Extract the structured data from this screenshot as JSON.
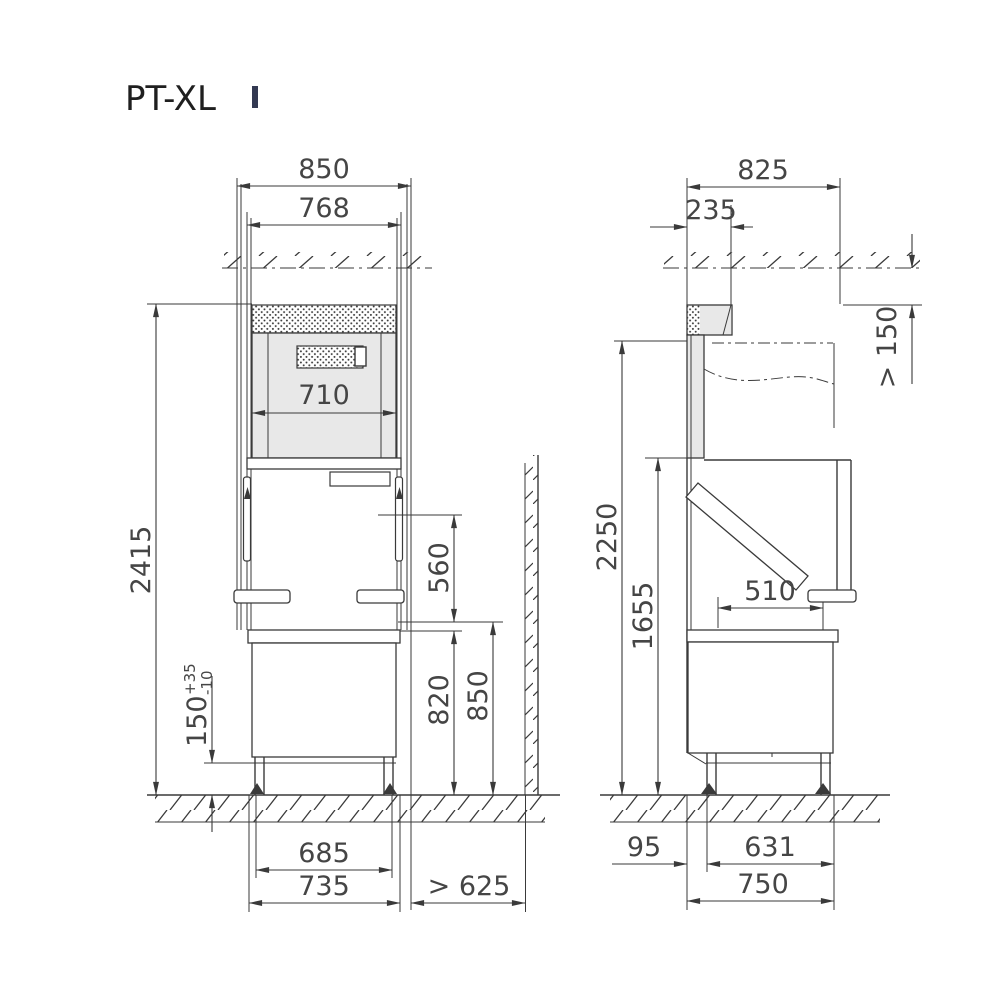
{
  "title": "PT-XL",
  "colors": {
    "line": "#3a3a3a",
    "panel_gray": "#e8e8e8"
  },
  "front_view": {
    "dims": {
      "overall_width": "850",
      "rail_width": "768",
      "passage_width": "710",
      "total_height": "2415",
      "hood_opening_height": "560",
      "counter_height": "820",
      "table_height": "850",
      "foot_height": "150",
      "foot_tolerance_plus": "+35",
      "foot_tolerance_minus": "-10",
      "feet_spacing": "685",
      "base_width": "735",
      "wall_clearance": "> 625"
    }
  },
  "side_view": {
    "dims": {
      "overall_depth": "825",
      "top_front_depth": "235",
      "ceiling_clearance": "> 150",
      "open_height": "2250",
      "loading_height": "1655",
      "table_opening_depth": "510",
      "front_depth": "425",
      "front_offset": "95",
      "feet_spacing": "631",
      "base_depth": "750"
    }
  }
}
